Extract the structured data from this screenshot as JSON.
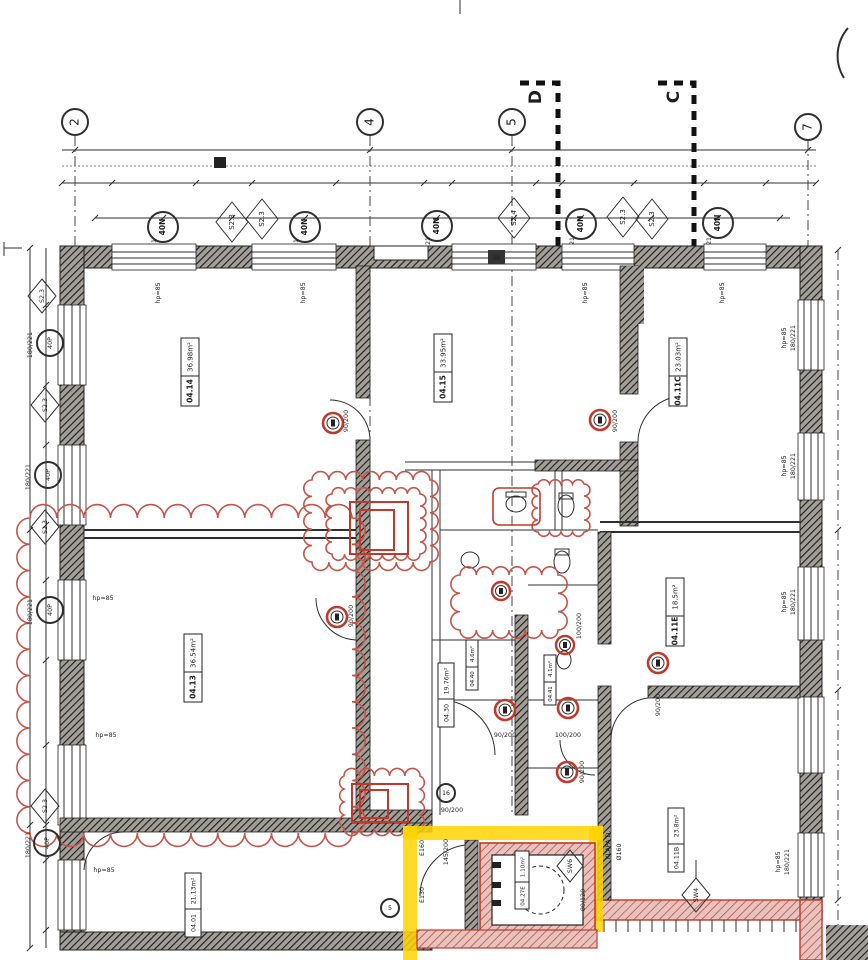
{
  "axes": [
    "2",
    "4",
    "5",
    "7"
  ],
  "sections": [
    "D",
    "C"
  ],
  "top_diamonds": [
    "S2.3",
    "S2.3",
    "S2.4",
    "S2.3",
    "S2.3"
  ],
  "left_diamonds": [
    "S2.3",
    "S2.3",
    "S2.3",
    "S2.3"
  ],
  "window_tags_top": [
    "40N",
    "40N",
    "40N",
    "40N",
    "40N"
  ],
  "window_tags_left": [
    "40P",
    "40P",
    "40P",
    "40P"
  ],
  "window_dim": "180/221",
  "sill": "hp=85",
  "rooms": [
    {
      "id": "04.14",
      "area": "36.98m²"
    },
    {
      "id": "04.15",
      "area": "33.95m²"
    },
    {
      "id": "04.11C",
      "area": "23.03m²"
    },
    {
      "id": "04.13",
      "area": "36.54m²"
    },
    {
      "id": "04.30",
      "area": "19.76m²"
    },
    {
      "id": "04.11E",
      "area": "18.5m²"
    },
    {
      "id": "04.01",
      "area": "21.13m²"
    },
    {
      "id": "04.11B",
      "area": "23.8m²"
    },
    {
      "id": "04.27E",
      "area": "1.10m²"
    },
    {
      "id": "04.40",
      "area": "4.6m²"
    },
    {
      "id": "04.41",
      "area": "4.1m²"
    }
  ],
  "door_tags": {
    "d90": "90/200",
    "d100": "100/200",
    "d145": "145/200",
    "d80": "80/120"
  },
  "labels": {
    "klapa": "KLAPA D.",
    "fi160": "Ø160",
    "e130": "E130",
    "e160": "E160",
    "sw6": "SW6",
    "sw4": "SW4",
    "n38": "38",
    "c16": "16",
    "c5": "5"
  },
  "colors": {
    "red": "#c0392b",
    "yellow": "#ffd400",
    "wall": "#2f2f2f",
    "pink": "#d98f8a"
  }
}
